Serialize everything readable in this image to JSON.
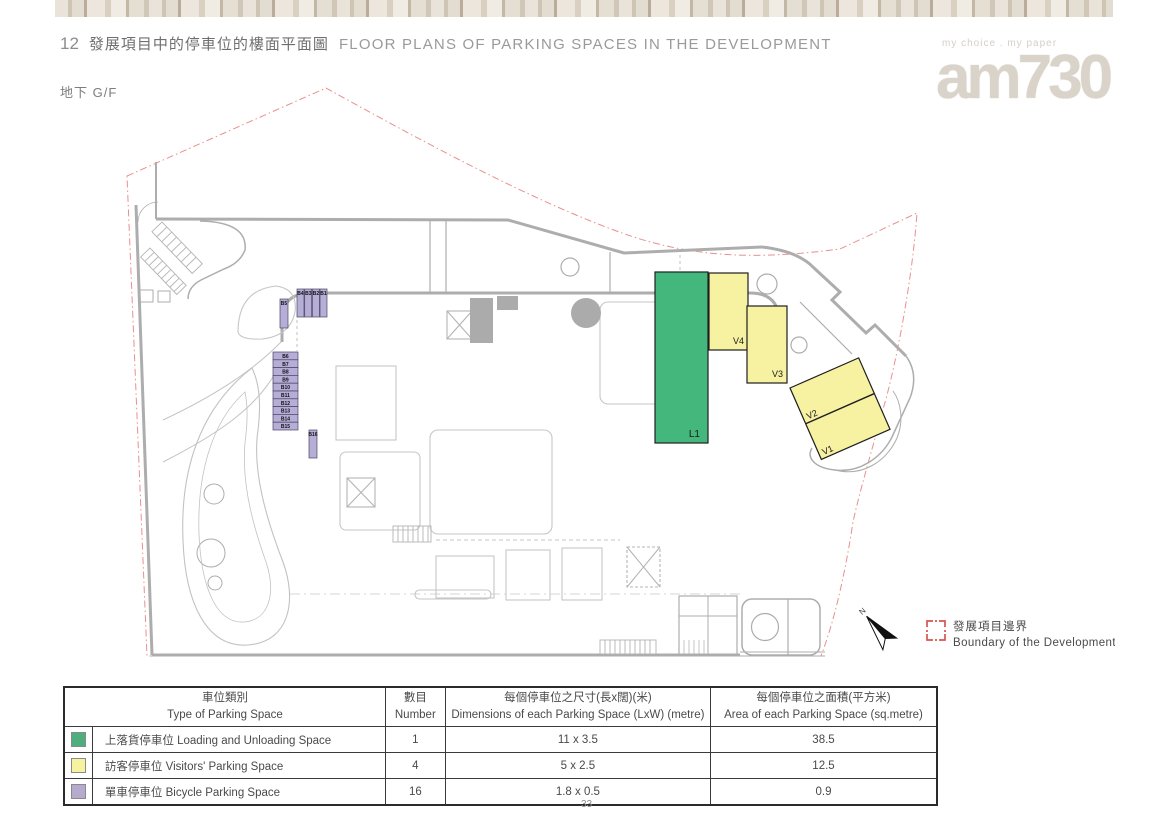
{
  "header": {
    "section_number": "12",
    "title_zh": "發展項目中的停車位的樓面平面圖",
    "title_en": "FLOOR PLANS OF PARKING SPACES IN THE DEVELOPMENT",
    "floor_label": "地下 G/F"
  },
  "watermark": {
    "tagline": "my choice . my paper",
    "logo": "am730"
  },
  "plan": {
    "labels": {
      "loading": "L1",
      "v1": "V1",
      "v2": "V2",
      "v3": "V3",
      "v4": "V4"
    },
    "bicycle_labels": [
      "B1",
      "B2",
      "B3",
      "B4",
      "B5",
      "B6",
      "B7",
      "B8",
      "B9",
      "B10",
      "B11",
      "B12",
      "B13",
      "B14",
      "B15",
      "B16"
    ],
    "north_label": "N",
    "legend": {
      "boundary_zh": "發展項目邊界",
      "boundary_en": "Boundary of the Development"
    },
    "colors": {
      "loading_space": "#44b77d",
      "visitor_space": "#f7f1a2",
      "bicycle_space": "#b6aed6",
      "boundary": "#d9534f",
      "walls": "#adadad"
    }
  },
  "table": {
    "headers": {
      "type_zh": "車位類別",
      "type_en": "Type of Parking Space",
      "number_zh": "數目",
      "number_en": "Number",
      "dims_zh": "每個停車位之尺寸(長x闊)(米)",
      "dims_en": "Dimensions of each Parking Space (LxW) (metre)",
      "area_zh": "每個停車位之面積(平方米)",
      "area_en": "Area of each Parking Space (sq.metre)"
    },
    "rows": [
      {
        "type": "上落貨停車位 Loading and Unloading Space",
        "number": "1",
        "dims": "11 x 3.5",
        "area": "38.5",
        "color": "#4caf7d"
      },
      {
        "type": "訪客停車位 Visitors' Parking Space",
        "number": "4",
        "dims": "5 x 2.5",
        "area": "12.5",
        "color": "#f5f2a0"
      },
      {
        "type": "單車停車位 Bicycle Parking Space",
        "number": "16",
        "dims": "1.8 x 0.5",
        "area": "0.9",
        "color": "#b7aacf"
      }
    ]
  },
  "page": {
    "number": "33"
  }
}
